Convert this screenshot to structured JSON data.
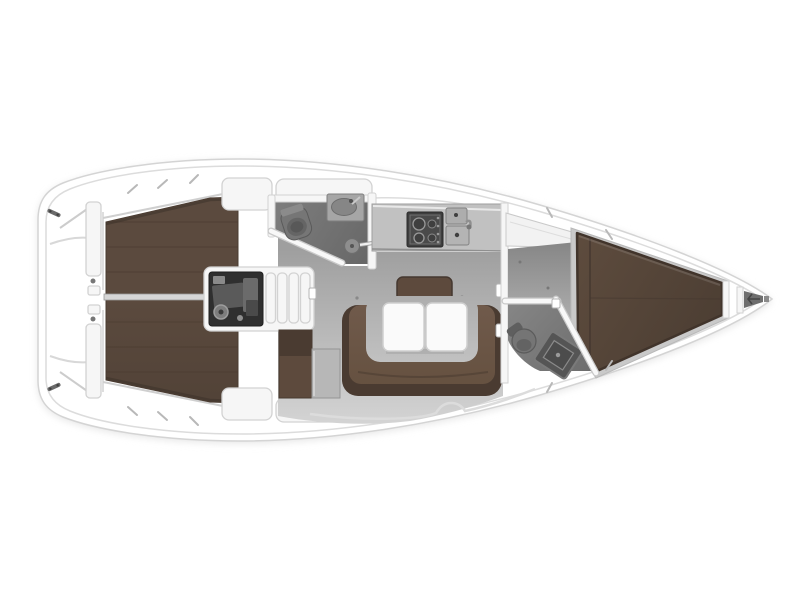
{
  "meta": {
    "view": "top-down sailboat interior floor plan",
    "bow_direction": "right",
    "stern_direction": "left"
  },
  "palette": {
    "hull_white": "#ffffff",
    "hull_line": "#d4d4d4",
    "hull_shadow": "#e4e4e4",
    "deck_fixture": "#f6f6f6",
    "deck_fixture_line": "#d2d2d2",
    "teak": "#5b4a3e",
    "teak_dark": "#41342b",
    "teak_seam": "#4a3c31",
    "sofa_brown": "#705a4b",
    "sofa_back_brown": "#4a3b31",
    "cushion_brown": "#5d4a3d",
    "floor_light": "#d4d4d4",
    "floor_dark": "#9f9f9f",
    "cabin_floor": "#929292",
    "head_floor": "#7a7a7a",
    "fixture_grey": "#9a9a9a",
    "fixture_dark": "#6f6f6f",
    "engine_bay": "#2f2f2f",
    "counter_grey": "#c1c1c1",
    "stove_dark": "#3e3e3e",
    "table_white": "#fafafa",
    "centerline_grey": "#d6d6d6"
  },
  "compartments": [
    {
      "name": "aft-deck-transom"
    },
    {
      "name": "twin-helm-stations"
    },
    {
      "name": "cockpit-teak-sole"
    },
    {
      "name": "cockpit-benches"
    },
    {
      "name": "engine-compartment"
    },
    {
      "name": "companionway-steps"
    },
    {
      "name": "aft-head-bathroom"
    },
    {
      "name": "galley"
    },
    {
      "name": "saloon-u-sofa-and-table"
    },
    {
      "name": "nav-seat-and-table"
    },
    {
      "name": "forward-head-bathroom"
    },
    {
      "name": "forward-cabin-v-berth"
    },
    {
      "name": "anchor-locker"
    }
  ]
}
